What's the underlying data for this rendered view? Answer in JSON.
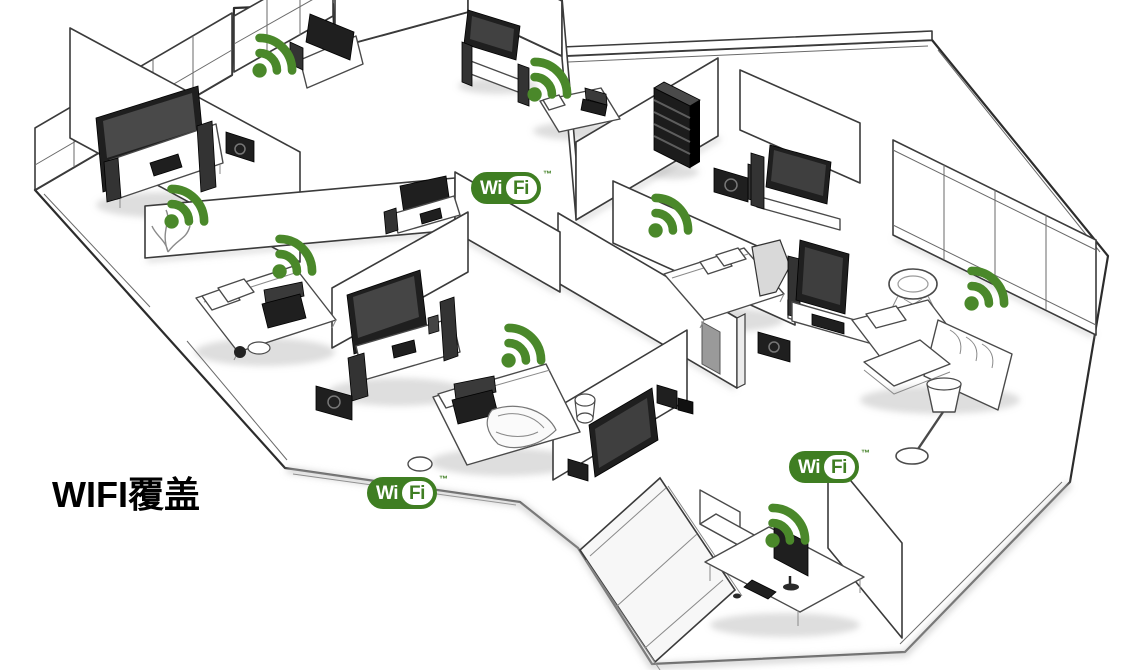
{
  "page": {
    "title": "WIFI覆盖"
  },
  "colors": {
    "signal_green": "#4a882a",
    "logo_green": "#3f7e22",
    "line_dark": "#2f2f2f"
  },
  "wifi_logo": {
    "wi": "Wi",
    "fi": "Fi",
    "tm": "™"
  },
  "wifi_logos": [
    {
      "id": "logo-center"
    },
    {
      "id": "logo-bottom-center"
    },
    {
      "id": "logo-bottom-right"
    }
  ],
  "signal_icons": [
    {
      "id": "signal-1",
      "glyph": "wifi-signal-arcs"
    },
    {
      "id": "signal-2",
      "glyph": "wifi-signal-arcs"
    },
    {
      "id": "signal-3",
      "glyph": "wifi-signal-arcs"
    },
    {
      "id": "signal-4",
      "glyph": "wifi-signal-arcs"
    },
    {
      "id": "signal-5",
      "glyph": "wifi-signal-arcs"
    },
    {
      "id": "signal-6",
      "glyph": "wifi-signal-arcs"
    },
    {
      "id": "signal-7",
      "glyph": "wifi-signal-arcs"
    },
    {
      "id": "signal-8",
      "glyph": "wifi-signal-arcs"
    }
  ]
}
